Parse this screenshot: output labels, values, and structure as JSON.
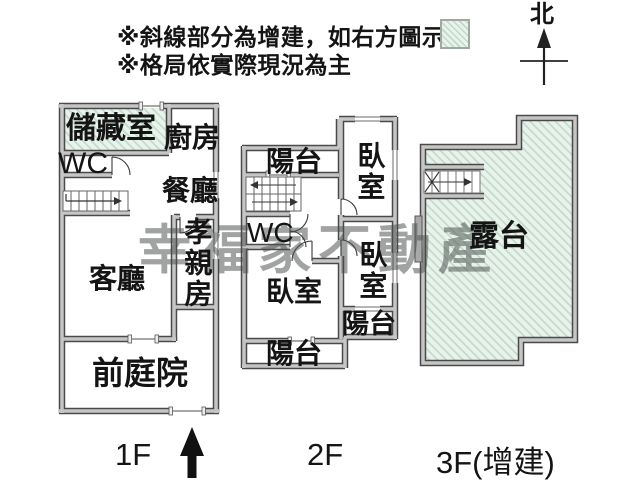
{
  "notes": {
    "line1": "※斜線部分為增建，如右方圖示",
    "line2": "※格局依實際現況為主"
  },
  "compass": {
    "north": "北"
  },
  "watermark": "幸福家不動產",
  "icons": {
    "legend_swatch": "hatch-square",
    "north_arrow": "arrow-up-with-crossbar",
    "entrance_arrow": "thick-arrow-up",
    "stairs": "stair-treads-with-direction-arrow"
  },
  "floors": {
    "f1": {
      "label": "1F",
      "rooms": {
        "storage": "儲藏室",
        "kitchen": "廚房",
        "wc": "WC",
        "dining": "餐廳",
        "parents_room": "孝親房",
        "living": "客廳",
        "front_yard": "前庭院"
      }
    },
    "f2": {
      "label": "2F",
      "rooms": {
        "balcony_top": "陽台",
        "bedroom_top_right": "臥室",
        "wc": "WC",
        "bedroom_main": "臥室",
        "bedroom_bottom_right": "臥室",
        "balcony_bottom_right": "陽台",
        "balcony_bottom_left": "陽台"
      }
    },
    "f3": {
      "label": "3F(增建)",
      "rooms": {
        "terrace": "露台"
      }
    }
  },
  "colors": {
    "addition_hatch_fill": "#e9f3ec",
    "addition_hatch_line": "#bfd9c8",
    "wall_core": "#c6c6c6",
    "wall_edge": "#4a4a4a",
    "text": "#141414",
    "watermark": "rgba(73,78,75,0.52)"
  }
}
